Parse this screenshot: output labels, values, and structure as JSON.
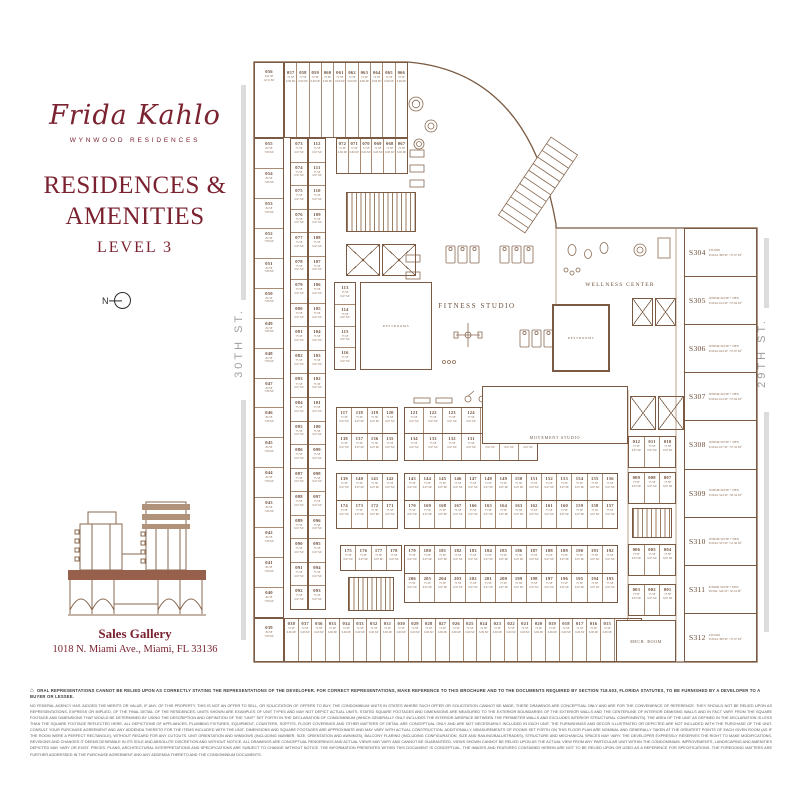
{
  "brand": {
    "logo_script": "Frida Kahlo",
    "logo_sub": "WYNWOOD RESIDENCES"
  },
  "page": {
    "title_line1": "RESIDENCES &",
    "title_line2": "AMENITIES",
    "level": "LEVEL 3",
    "north_label": "N"
  },
  "sales_gallery": {
    "title": "Sales Gallery",
    "address": "1018 N. Miami Ave., Miami, FL 33136"
  },
  "streets": {
    "left": "30TH ST.",
    "right": "29TH ST."
  },
  "colors": {
    "brand": "#7b2230",
    "plan_line": "#7a5a42"
  },
  "icons": {
    "equal_housing": "⌂"
  },
  "plan": {
    "labels": {
      "fitness": "FITNESS STUDIO",
      "wellness": "WELLNESS CENTER",
      "movement": "MOVEMENT STUDIO",
      "restrooms": "RESTROOMS",
      "mech": "MECH. ROOM"
    },
    "areas": {
      "s72": "72 SF\n6.69 M²",
      "s75": "75 SF\n6.97 M²",
      "s84": "84 SF\n7.80 M²"
    },
    "corner_top": {
      "n": "056",
      "a": "242 SF\n22.51 M²"
    },
    "corner_bottom": {
      "n": "039",
      "a": "84 SF\n7.80 M²"
    },
    "top_row": [
      "057",
      "058",
      "059",
      "060",
      "061",
      "062",
      "063",
      "064",
      "065",
      "066"
    ],
    "row2": [
      "072",
      "071",
      "070",
      "069",
      "068",
      "067"
    ],
    "left_col": [
      "055",
      "054",
      "053",
      "052",
      "051",
      "050",
      "049",
      "048",
      "047",
      "046",
      "045",
      "044",
      "043",
      "042",
      "041",
      "040"
    ],
    "pair_left": [
      "073",
      "074",
      "075",
      "076",
      "077",
      "078",
      "079",
      "080",
      "081",
      "082",
      "083",
      "084",
      "085",
      "086",
      "087",
      "088",
      "089",
      "090",
      "091",
      "092"
    ],
    "pair_right": [
      "112",
      "111",
      "110",
      "109",
      "108",
      "107",
      "106",
      "105",
      "104",
      "103",
      "102",
      "101",
      "100",
      "099",
      "098",
      "097",
      "096",
      "095",
      "094",
      "093"
    ],
    "col113": [
      "113",
      "114",
      "115",
      "116"
    ],
    "block_a_top": [
      "117",
      "118",
      "119",
      "120"
    ],
    "block_a_bottom": [
      "138",
      "137",
      "136",
      "135"
    ],
    "block_b_top": [
      "121",
      "122",
      "123",
      "124",
      "125",
      "126",
      "127"
    ],
    "block_b_bottom": [
      "134",
      "133",
      "132",
      "131",
      "130",
      "129",
      "128"
    ],
    "block_c_top": [
      "139",
      "140",
      "141",
      "142"
    ],
    "block_c_bottom": [
      "174",
      "173",
      "172",
      "171"
    ],
    "block_d_top": [
      "143",
      "144",
      "145",
      "146",
      "147",
      "148",
      "149",
      "150",
      "151",
      "152",
      "153",
      "154",
      "155",
      "156"
    ],
    "block_d_bottom": [
      "170",
      "169",
      "168",
      "167",
      "166",
      "165",
      "164",
      "163",
      "162",
      "161",
      "160",
      "159",
      "158",
      "157"
    ],
    "block_e": [
      "175",
      "176",
      "177",
      "178"
    ],
    "block_f_top": [
      "179",
      "180",
      "181",
      "182",
      "183",
      "184",
      "185",
      "186",
      "187",
      "188",
      "189",
      "190",
      "191",
      "192"
    ],
    "block_f_bottom": [
      "206",
      "205",
      "204",
      "203",
      "202",
      "201",
      "200",
      "199",
      "198",
      "197",
      "196",
      "195",
      "194",
      "193"
    ],
    "bottom_row": [
      "038",
      "037",
      "036",
      "035",
      "034",
      "033",
      "032",
      "031",
      "030",
      "029",
      "028",
      "027",
      "026",
      "025",
      "024",
      "023",
      "022",
      "021",
      "020",
      "019",
      "018",
      "017",
      "016",
      "015",
      "014",
      "013"
    ],
    "t1": [
      "012",
      "011",
      "010"
    ],
    "t2": [
      "009",
      "008",
      "007"
    ],
    "t3": [
      "006",
      "005",
      "004"
    ],
    "t4": [
      "003",
      "002",
      "001"
    ],
    "suites": [
      {
        "id": "S304",
        "type": "STUDIO",
        "area": "TOTAL 399 SF | 37.07 M²"
      },
      {
        "id": "S305",
        "type": "JUNIOR SUITE + DEN",
        "area": "TOTAL 614 SF | 57.04 M²"
      },
      {
        "id": "S306",
        "type": "JUNIOR SUITE + DEN",
        "area": "TOTAL 624 SF | 57.97 M²"
      },
      {
        "id": "S307",
        "type": "JUNIOR SUITE + DEN",
        "area": "TOTAL 614 SF | 57.04 M²"
      },
      {
        "id": "S308",
        "type": "JUNIOR SUITE + DEN",
        "area": "TOTAL 617 SF | 57.32 M²"
      },
      {
        "id": "S309",
        "type": "JUNIOR SUITE + DEN",
        "area": "TOTAL 544 SF | 50.54 M²"
      },
      {
        "id": "S310",
        "type": "JUNIOR SUITE + DEN",
        "area": "TOTAL 555 SF | 51.56 M²"
      },
      {
        "id": "S311",
        "type": "JUNIOR SUITE + DEN",
        "area": "TOTAL 544 SF | 50.54 M²"
      },
      {
        "id": "S312",
        "type": "STUDIO",
        "area": "TOTAL 399 SF | 37.07 M²"
      }
    ]
  },
  "disclaimer": {
    "headline": "ORAL REPRESENTATIONS CANNOT BE RELIED UPON AS CORRECTLY STATING THE REPRESENTATIONS OF THE DEVELOPER. FOR CORRECT REPRESENTATIONS, MAKE REFERENCE TO THIS BROCHURE AND TO THE DOCUMENTS REQUIRED BY SECTION 718.503, FLORIDA STATUTES, TO BE FURNISHED BY A DEVELOPER TO A BUYER OR LESSEE.",
    "body": "NO FEDERAL AGENCY HAS JUDGED THE MERITS OR VALUE, IF ANY, OF THIS PROPERTY. THIS IS NOT AN OFFER TO SELL, OR SOLICITATION OF OFFERS TO BUY, THE CONDOMINIUM UNITS IN STATES WHERE SUCH OFFER OR SOLICITATION CANNOT BE MADE. THESE DRAWINGS ARE CONCEPTUAL ONLY AND ARE FOR THE CONVENIENCE OF REFERENCE. THEY SHOULD NOT BE RELIED UPON AS REPRESENTATIONS, EXPRESS OR IMPLIED, OF THE FINAL DETAIL OF THE RESIDENCES. UNITS SHOWN ARE EXAMPLES OF UNIT TYPES AND MAY NOT DEPICT ACTUAL UNITS. STATED SQUARE FOOTAGES AND DIMENSIONS ARE MEASURED TO THE EXTERIOR BOUNDARIES OF THE EXTERIOR WALLS AND THE CENTERLINE OF INTERIOR DEMISING WALLS AND IN FACT VARY FROM THE SQUARE FOOTAGE AND DIMENSIONS THAT WOULD BE DETERMINED BY USING THE DESCRIPTION AND DEFINITION OF THE \"UNIT\" SET FORTH IN THE DECLARATION OF CONDOMINIUM (WHICH GENERALLY ONLY INCLUDES THE INTERIOR AIRSPACE BETWEEN THE PERIMETER WALLS AND EXCLUDES INTERIOR STRUCTURAL COMPONENTS). THE AREA OF THE UNIT AS DEFINED IN THE DECLARATION IS LESS THAN THE SQUARE FOOTAGE REFLECTED HERE. ALL DEPICTIONS OF APPLIANCES, PLUMBING FIXTURES, EQUIPMENT, COUNTERS, SOFFITS, FLOOR COVERINGS AND OTHER MATTERS OF DETAIL ARE CONCEPTUAL ONLY AND ARE NOT NECESSARILY INCLUDED IN EACH UNIT. THE FURNISHINGS AND DECOR ILLUSTRATED OR DEPICTED ARE NOT INCLUDED WITH THE PURCHASE OF THE UNIT. CONSULT YOUR PURCHASE AGREEMENT AND ANY ADDENDA THERETO FOR THE ITEMS INCLUDED WITH THE UNIT. DIMENSIONS AND SQUARE FOOTAGES ARE APPROXIMATE AND MAY VARY WITH ACTUAL CONSTRUCTION. ADDITIONALLY, MEASUREMENTS OF ROOMS SET FORTH ON THIS FLOOR PLAN ARE NOMINAL AND GENERALLY TAKEN AT THE GREATEST POINTS OF EACH GIVEN ROOM (AS IF THE ROOM WERE A PERFECT RECTANGLE), WITHOUT REGARD FOR ANY CUTOUTS. UNIT ORIENTATION AND WINDOWS (INCLUDING NUMBER, SIZE, ORIENTATION AND AWNINGS), BALCONY FLARING (INCLUDING CONFIGURATION, SIZE AND RAILING/BALUSTRADES), STRUCTURE AND MECHANICAL SPACES MAY VARY. THE DEVELOPER EXPRESSLY RESERVES THE RIGHT TO MAKE MODIFICATIONS, REVISIONS AND CHANGES IT DEEMS DESIRABLE IN ITS SOLE AND ABSOLUTE DISCRETION AND WITHOUT NOTICE. ALL DRAWINGS ARE CONCEPTUAL RENDERINGS AND ACTUAL VIEWS MAY VARY AND CANNOT BE GUARANTEED. VIEWS SHOWN CANNOT BE RELIED UPON AS THE ACTUAL VIEW FROM ANY PARTICULAR UNIT WITHIN THE CONDOMINIUM. IMPROVEMENTS, LANDSCAPING AND AMENITIES DEPICTED MAY VARY OR EXIST. PRICES, PLANS, ARCHITECTURAL INTERPRETATIONS AND SPECIFICATIONS ARE SUBJECT TO CHANGE WITHOUT NOTICE. THE INFORMATION PRESENTED WITHIN THIS DOCUMENT IS CONCEPTUAL. THE IMAGES AND FEATURES CONTAINED HEREIN ARE NOT TO BE RELIED UPON OR USED AS A REFERENCE FOR SPECIFICATIONS. THE FOREGOING MATTERS ARE FURTHER ADDRESSED IN THE PURCHASE AGREEMENT AND ANY ADDENDA THERETO AND THE CONDOMINIUM DOCUMENTS."
  }
}
